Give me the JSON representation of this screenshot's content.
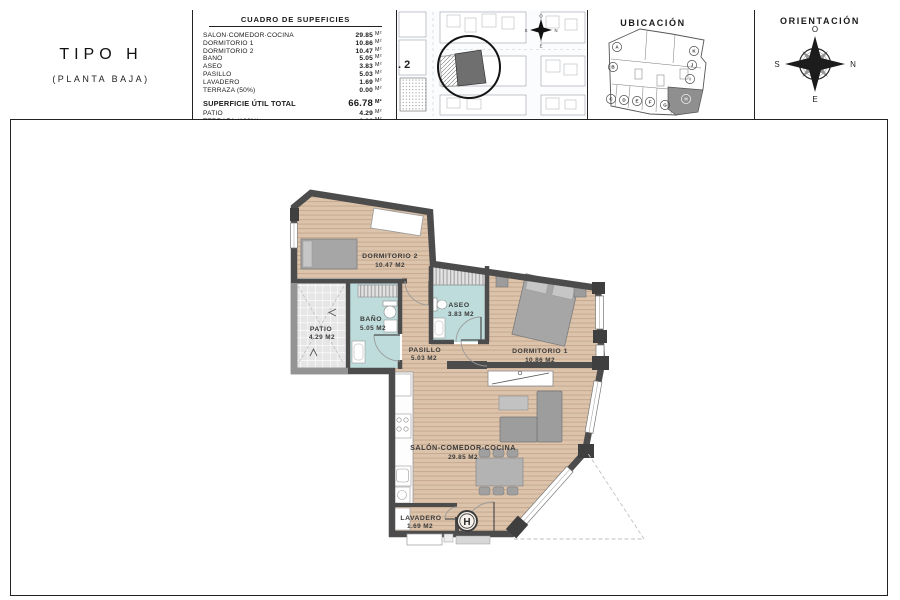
{
  "title_block": {
    "line1": "TIPO H",
    "line2": "(PLANTA BAJA)"
  },
  "surface_table": {
    "title": "CUADRO DE SUPEFICIES",
    "unit": "M²",
    "rows": [
      {
        "label": "SALÓN·COMEDOR·COCINA",
        "value": "29.85"
      },
      {
        "label": "DORMITORIO 1",
        "value": "10.86"
      },
      {
        "label": "DORMITORIO 2",
        "value": "10.47"
      },
      {
        "label": "BAÑO",
        "value": "5.05"
      },
      {
        "label": "ASEO",
        "value": "3.83"
      },
      {
        "label": "PASILLO",
        "value": "5.03"
      },
      {
        "label": "LAVADERO",
        "value": "1.69"
      },
      {
        "label": "TERRAZA (50%)",
        "value": "0.00"
      }
    ],
    "total": {
      "label": "SUPERFICIE ÚTIL TOTAL",
      "value": "66.78"
    },
    "extra_rows": [
      {
        "label": "PATIO",
        "value": "4.29"
      },
      {
        "label": "TERRAZA (100%)",
        "value": "0.00"
      }
    ]
  },
  "site_plan": {
    "plot_label": ". 2",
    "compass": {
      "top": "O",
      "right": "N",
      "bottom": "E",
      "left": "S"
    }
  },
  "ubicacion": {
    "title": "UBICACIÓN",
    "units": [
      "A",
      "B",
      "C",
      "D",
      "E",
      "F",
      "G",
      "H",
      "I",
      "J",
      "K"
    ],
    "highlighted_unit": "H"
  },
  "orientacion": {
    "title": "ORIENTACIÓN",
    "compass": {
      "top": "O",
      "right": "N",
      "bottom": "E",
      "left": "S"
    }
  },
  "floor_plan": {
    "unit_badge": "H",
    "rooms": [
      {
        "name": "DORMITORIO 2",
        "area": "10.47 M2"
      },
      {
        "name": "DORMITORIO 1",
        "area": "10.86 M2"
      },
      {
        "name": "BAÑO",
        "area": "5.05 M2"
      },
      {
        "name": "ASEO",
        "area": "3.83 M2"
      },
      {
        "name": "PASILLO",
        "area": "5.03 M2"
      },
      {
        "name": "PATIO",
        "area": "4.29 M2"
      },
      {
        "name": "SALÓN-COMEDOR-COCINA",
        "area": "29.85 M2"
      },
      {
        "name": "LAVADERO",
        "area": "1.69 M2"
      }
    ]
  },
  "colors": {
    "wall": "#4c4c4c",
    "wood": "#dcc3ab",
    "wet_room": "#bedcdb",
    "plot": "#6f6f6f"
  }
}
